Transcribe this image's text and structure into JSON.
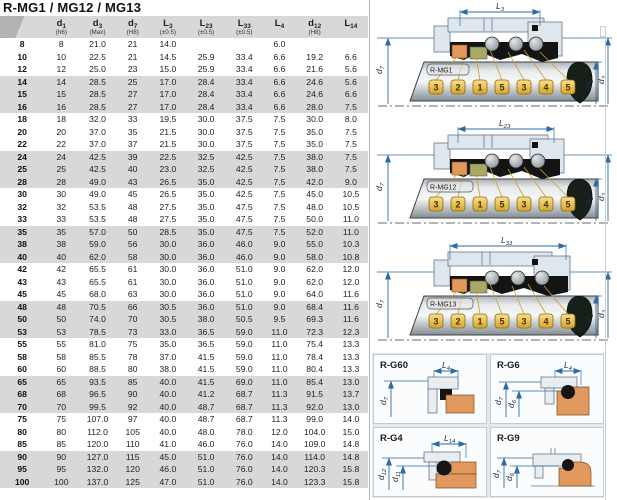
{
  "title": "R-MG1 / MG12 / MG13",
  "table": {
    "columns": [
      {
        "base": "",
        "sub": "",
        "tol": ""
      },
      {
        "base": "d",
        "sub": "1",
        "tol": "(h6)"
      },
      {
        "base": "d",
        "sub": "3",
        "tol": "(Max)"
      },
      {
        "base": "d",
        "sub": "7",
        "tol": "(H8)"
      },
      {
        "base": "L",
        "sub": "3",
        "tol": "(±0.5)"
      },
      {
        "base": "L",
        "sub": "23",
        "tol": "(±0.5)"
      },
      {
        "base": "L",
        "sub": "33",
        "tol": "(±0.5)"
      },
      {
        "base": "L",
        "sub": "4",
        "tol": ""
      },
      {
        "base": "d",
        "sub": "12",
        "tol": "(H8)"
      },
      {
        "base": "L",
        "sub": "14",
        "tol": ""
      }
    ],
    "rows": [
      [
        "8",
        "8",
        "21.0",
        "21",
        "14.0",
        "",
        "",
        "6.0",
        "",
        ""
      ],
      [
        "10",
        "10",
        "22.5",
        "21",
        "14.5",
        "25.9",
        "33.4",
        "6.6",
        "19.2",
        "6.6"
      ],
      [
        "12",
        "12",
        "25.0",
        "23",
        "15.0",
        "25.9",
        "33.4",
        "6.6",
        "21.6",
        "5.6"
      ],
      [
        "14",
        "14",
        "28.5",
        "25",
        "17.0",
        "28.4",
        "33.4",
        "6.6",
        "24.6",
        "5.6"
      ],
      [
        "15",
        "15",
        "28.5",
        "27",
        "17.0",
        "28.4",
        "33.4",
        "6.6",
        "24.6",
        "6.6"
      ],
      [
        "16",
        "16",
        "28.5",
        "27",
        "17.0",
        "28.4",
        "33.4",
        "6.6",
        "28.0",
        "7.5"
      ],
      [
        "18",
        "18",
        "32.0",
        "33",
        "19.5",
        "30.0",
        "37.5",
        "7.5",
        "30.0",
        "8.0"
      ],
      [
        "20",
        "20",
        "37.0",
        "35",
        "21.5",
        "30.0",
        "37.5",
        "7.5",
        "35.0",
        "7.5"
      ],
      [
        "22",
        "22",
        "37.0",
        "37",
        "21.5",
        "30.0",
        "37.5",
        "7.5",
        "35.0",
        "7.5"
      ],
      [
        "24",
        "24",
        "42.5",
        "39",
        "22.5",
        "32.5",
        "42.5",
        "7.5",
        "38.0",
        "7.5"
      ],
      [
        "25",
        "25",
        "42.5",
        "40",
        "23.0",
        "32.5",
        "42.5",
        "7.5",
        "38.0",
        "7.5"
      ],
      [
        "28",
        "28",
        "49.0",
        "43",
        "26.5",
        "35.0",
        "42.5",
        "7.5",
        "42.0",
        "9.0"
      ],
      [
        "30",
        "30",
        "49.0",
        "45",
        "26.5",
        "35.0",
        "42.5",
        "7.5",
        "45.0",
        "10.5"
      ],
      [
        "32",
        "32",
        "53.5",
        "48",
        "27.5",
        "35.0",
        "47.5",
        "7.5",
        "48.0",
        "10.5"
      ],
      [
        "33",
        "33",
        "53.5",
        "48",
        "27.5",
        "35.0",
        "47.5",
        "7.5",
        "50.0",
        "11.0"
      ],
      [
        "35",
        "35",
        "57.0",
        "50",
        "28.5",
        "35.0",
        "47.5",
        "7.5",
        "52.0",
        "11.0"
      ],
      [
        "38",
        "38",
        "59.0",
        "56",
        "30.0",
        "36.0",
        "46.0",
        "9.0",
        "55.0",
        "10.3"
      ],
      [
        "40",
        "40",
        "62.0",
        "58",
        "30.0",
        "36.0",
        "46.0",
        "9.0",
        "58.0",
        "10.8"
      ],
      [
        "42",
        "42",
        "65.5",
        "61",
        "30.0",
        "36.0",
        "51.0",
        "9.0",
        "62.0",
        "12.0"
      ],
      [
        "43",
        "43",
        "65.5",
        "61",
        "30.0",
        "36.0",
        "51.0",
        "9.0",
        "62.0",
        "12.0"
      ],
      [
        "45",
        "45",
        "68.0",
        "63",
        "30.0",
        "36.0",
        "51.0",
        "9.0",
        "64.0",
        "11.6"
      ],
      [
        "48",
        "48",
        "70.5",
        "66",
        "30.5",
        "36.0",
        "51.0",
        "9.0",
        "68.4",
        "11.6"
      ],
      [
        "50",
        "50",
        "74.0",
        "70",
        "30.5",
        "38.0",
        "50.5",
        "9.5",
        "69.3",
        "11.6"
      ],
      [
        "53",
        "53",
        "78.5",
        "73",
        "33.0",
        "36.5",
        "59.0",
        "11.0",
        "72.3",
        "12.3"
      ],
      [
        "55",
        "55",
        "81.0",
        "75",
        "35.0",
        "36.5",
        "59.0",
        "11.0",
        "75.4",
        "13.3"
      ],
      [
        "58",
        "58",
        "85.5",
        "78",
        "37.0",
        "41.5",
        "59.0",
        "11.0",
        "78.4",
        "13.3"
      ],
      [
        "60",
        "60",
        "88.5",
        "80",
        "38.0",
        "41.5",
        "59.0",
        "11.0",
        "80.4",
        "13.3"
      ],
      [
        "65",
        "65",
        "93.5",
        "85",
        "40.0",
        "41.5",
        "69.0",
        "11.0",
        "85.4",
        "13.0"
      ],
      [
        "68",
        "68",
        "96.5",
        "90",
        "40.0",
        "41.2",
        "68.7",
        "11.3",
        "91.5",
        "13.7"
      ],
      [
        "70",
        "70",
        "99.5",
        "92",
        "40.0",
        "48.7",
        "68.7",
        "11.3",
        "92.0",
        "13.0"
      ],
      [
        "75",
        "75",
        "107.0",
        "97",
        "40.0",
        "48.7",
        "68.7",
        "11.3",
        "99.0",
        "14.0"
      ],
      [
        "80",
        "80",
        "112.0",
        "105",
        "40.0",
        "48.0",
        "78.0",
        "12.0",
        "104.0",
        "15.0"
      ],
      [
        "85",
        "85",
        "120.0",
        "110",
        "41.0",
        "46.0",
        "76.0",
        "14.0",
        "109.0",
        "14.8"
      ],
      [
        "90",
        "90",
        "127.0",
        "115",
        "45.0",
        "51.0",
        "76.0",
        "14.0",
        "114.0",
        "14.8"
      ],
      [
        "95",
        "95",
        "132.0",
        "120",
        "46.0",
        "51.0",
        "76.0",
        "14.0",
        "120.3",
        "15.8"
      ],
      [
        "100",
        "100",
        "137.0",
        "125",
        "47.0",
        "51.0",
        "76.0",
        "14.0",
        "123.3",
        "15.8"
      ]
    ]
  },
  "seal": {
    "tags": [
      "3",
      "2",
      "1",
      "5",
      "3",
      "4",
      "5"
    ],
    "dims": {
      "d7": {
        "base": "d",
        "sub": "7"
      },
      "d1": {
        "base": "d",
        "sub": "1"
      },
      "d3": {
        "base": "d",
        "sub": "3"
      }
    },
    "diagrams": [
      {
        "label": "R-MG1",
        "dim_top": {
          "base": "L",
          "sub": "3"
        }
      },
      {
        "label": "R-MG12",
        "dim_top": {
          "base": "L",
          "sub": "23"
        }
      },
      {
        "label": "R-MG13",
        "dim_top": {
          "base": "L",
          "sub": "33"
        }
      }
    ]
  },
  "panels": [
    {
      "label": "R-G60",
      "dim_top": {
        "base": "L",
        "sub": "4"
      },
      "dim_left1": {
        "base": "d",
        "sub": "7"
      }
    },
    {
      "label": "R-G6",
      "dim_top": {
        "base": "L",
        "sub": "4"
      },
      "dim_left1": {
        "base": "d",
        "sub": "7"
      },
      "dim_left2": {
        "base": "d",
        "sub": "6"
      }
    },
    {
      "label": "R-G4",
      "dim_top": {
        "base": "L",
        "sub": "14"
      },
      "dim_left1": {
        "base": "d",
        "sub": "12"
      },
      "dim_left2": {
        "base": "d",
        "sub": "11"
      }
    },
    {
      "label": "R-G9",
      "dim_left1": {
        "base": "d",
        "sub": "7"
      },
      "dim_left2": {
        "base": "d",
        "sub": "6"
      }
    }
  ],
  "colors": {
    "dimension_blue": "#2e6da4",
    "tag_gold": "#f0cb4e",
    "seat_orange": "#e2995e",
    "olive_ring": "#a8a868",
    "housing_gray": "#dfe7ee",
    "row_band_gray": "#d8d8d8"
  }
}
